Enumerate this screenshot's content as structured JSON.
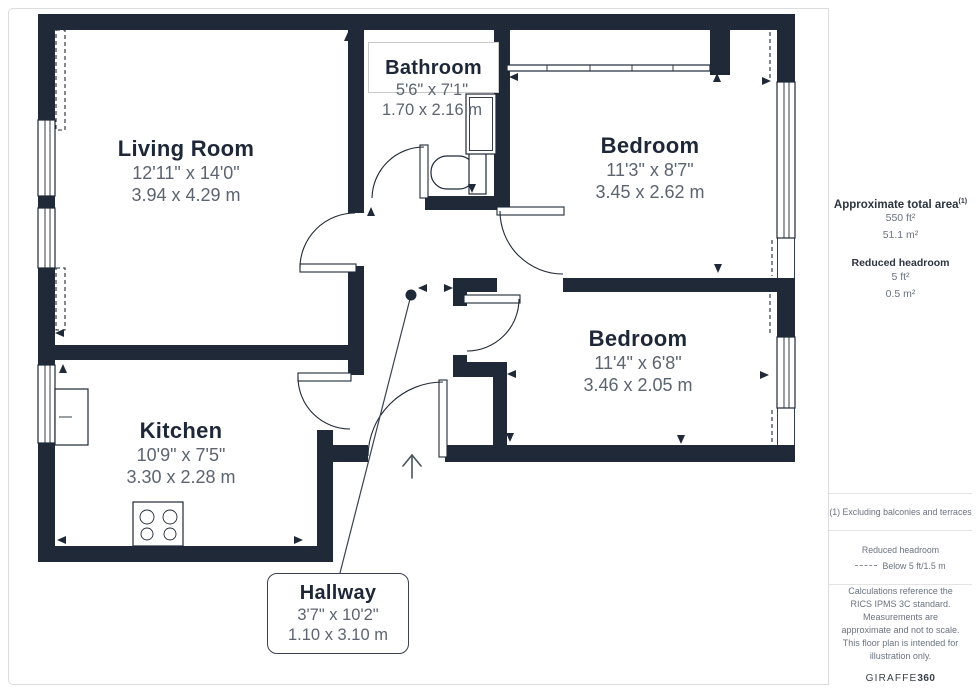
{
  "plan": {
    "colors": {
      "wall": "#1f2937",
      "title_text": "#1d2737",
      "dim_text": "#5b6470"
    },
    "rooms": [
      {
        "name": "Living Room",
        "imperial": "12'11\" x 14'0\"",
        "metric": "3.94 x 4.29 m"
      },
      {
        "name": "Bathroom",
        "imperial": "5'6\" x 7'1\"",
        "metric": "1.70 x 2.16 m"
      },
      {
        "name": "Bedroom",
        "imperial": "11'3\" x 8'7\"",
        "metric": "3.45 x 2.62 m"
      },
      {
        "name": "Bedroom",
        "imperial": "11'4\" x 6'8\"",
        "metric": "3.46 x 2.05 m"
      },
      {
        "name": "Kitchen",
        "imperial": "10'9\" x 7'5\"",
        "metric": "3.30 x 2.28 m"
      },
      {
        "name": "Hallway",
        "imperial": "3'7\" x 10'2\"",
        "metric": "1.10 x 3.10 m"
      }
    ]
  },
  "sidebar": {
    "total_area": {
      "label": "Approximate total area",
      "superscript": "(1)",
      "value_ft": "550 ft²",
      "value_m": "51.1 m²"
    },
    "reduced_headroom": {
      "label": "Reduced headroom",
      "value_ft": "5 ft²",
      "value_m": "0.5 m²"
    },
    "footnote": "(1) Excluding balconies and terraces",
    "legend": {
      "label": "Reduced headroom",
      "value": "Below 5 ft/1.5 m"
    },
    "disclaimer": "Calculations reference the RICS IPMS 3C standard. Measurements are approximate and not to scale. This floor plan is intended for illustration only.",
    "brand": {
      "name": "GIRAFFE",
      "suffix": "360"
    }
  }
}
